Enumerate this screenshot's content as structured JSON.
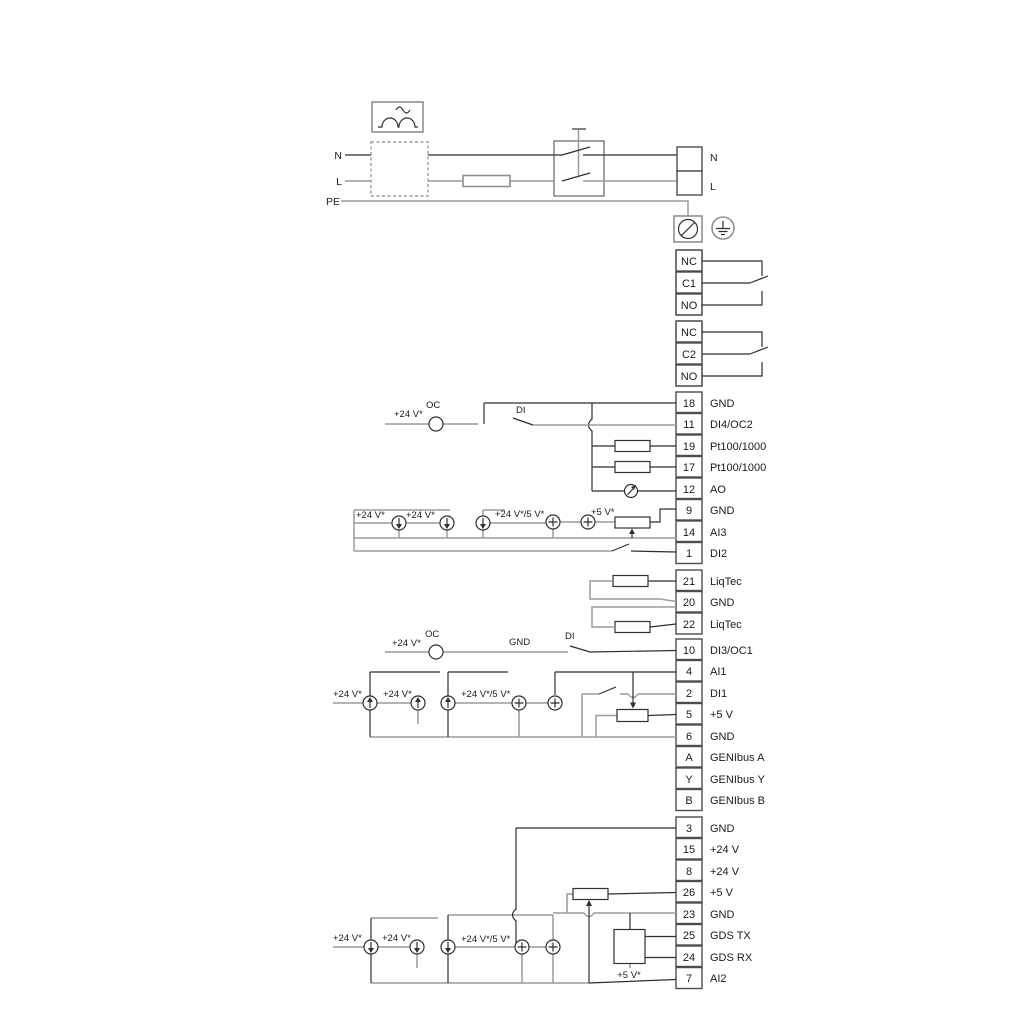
{
  "colors": {
    "wire_grey": "#9c9c9c",
    "wire_dark": "#2f2f2f",
    "terminal_border": "#4c4c4c",
    "text": "#1b1b1b",
    "background": "#ffffff"
  },
  "power": {
    "n_left": "N",
    "l_left": "L",
    "pe": "PE",
    "n_right": "N",
    "l_right": "L"
  },
  "relay1": [
    "NC",
    "C1",
    "NO"
  ],
  "relay2": [
    "NC",
    "C2",
    "NO"
  ],
  "g1": [
    {
      "num": "18",
      "label": "GND"
    },
    {
      "num": "11",
      "label": "DI4/OC2"
    },
    {
      "num": "19",
      "label": "Pt100/1000"
    },
    {
      "num": "17",
      "label": "Pt100/1000"
    },
    {
      "num": "12",
      "label": "AO"
    },
    {
      "num": "9",
      "label": "GND"
    },
    {
      "num": "14",
      "label": "AI3"
    },
    {
      "num": "1",
      "label": "DI2"
    }
  ],
  "liqtec": [
    {
      "num": "21",
      "label": "LiqTec"
    },
    {
      "num": "20",
      "label": "GND"
    },
    {
      "num": "22",
      "label": "LiqTec"
    }
  ],
  "g2": [
    {
      "num": "10",
      "label": "DI3/OC1"
    },
    {
      "num": "4",
      "label": "AI1"
    },
    {
      "num": "2",
      "label": "DI1"
    },
    {
      "num": "5",
      "label": "+5 V"
    },
    {
      "num": "6",
      "label": "GND"
    },
    {
      "num": "A",
      "label": "GENIbus A"
    },
    {
      "num": "Y",
      "label": "GENIbus Y"
    },
    {
      "num": "B",
      "label": "GENIbus B"
    }
  ],
  "g3": [
    {
      "num": "3",
      "label": "GND"
    },
    {
      "num": "15",
      "label": "+24 V"
    },
    {
      "num": "8",
      "label": "+24 V"
    },
    {
      "num": "26",
      "label": "+5 V"
    },
    {
      "num": "23",
      "label": "GND"
    },
    {
      "num": "25",
      "label": "GDS TX"
    },
    {
      "num": "24",
      "label": "GDS RX"
    },
    {
      "num": "7",
      "label": "AI2"
    }
  ],
  "ann": {
    "di4": {
      "v24": "+24 V*",
      "oc": "OC",
      "di": "DI"
    },
    "ai3": {
      "v24a": "+24 V*",
      "v24b": "+24 V*",
      "v24_5": "+24 V*/5 V*",
      "v5": "+5 V*"
    },
    "di3": {
      "v24": "+24 V*",
      "oc": "OC",
      "gnd": "GND",
      "di": "DI"
    },
    "ai1": {
      "v24a": "+24 V*",
      "v24b": "+24 V*",
      "v24_5": "+24 V*/5 V*"
    },
    "ai2": {
      "v24a": "+24 V*",
      "v24b": "+24 V*",
      "v24_5": "+24 V*/5 V*",
      "v5": "+5 V*"
    }
  }
}
